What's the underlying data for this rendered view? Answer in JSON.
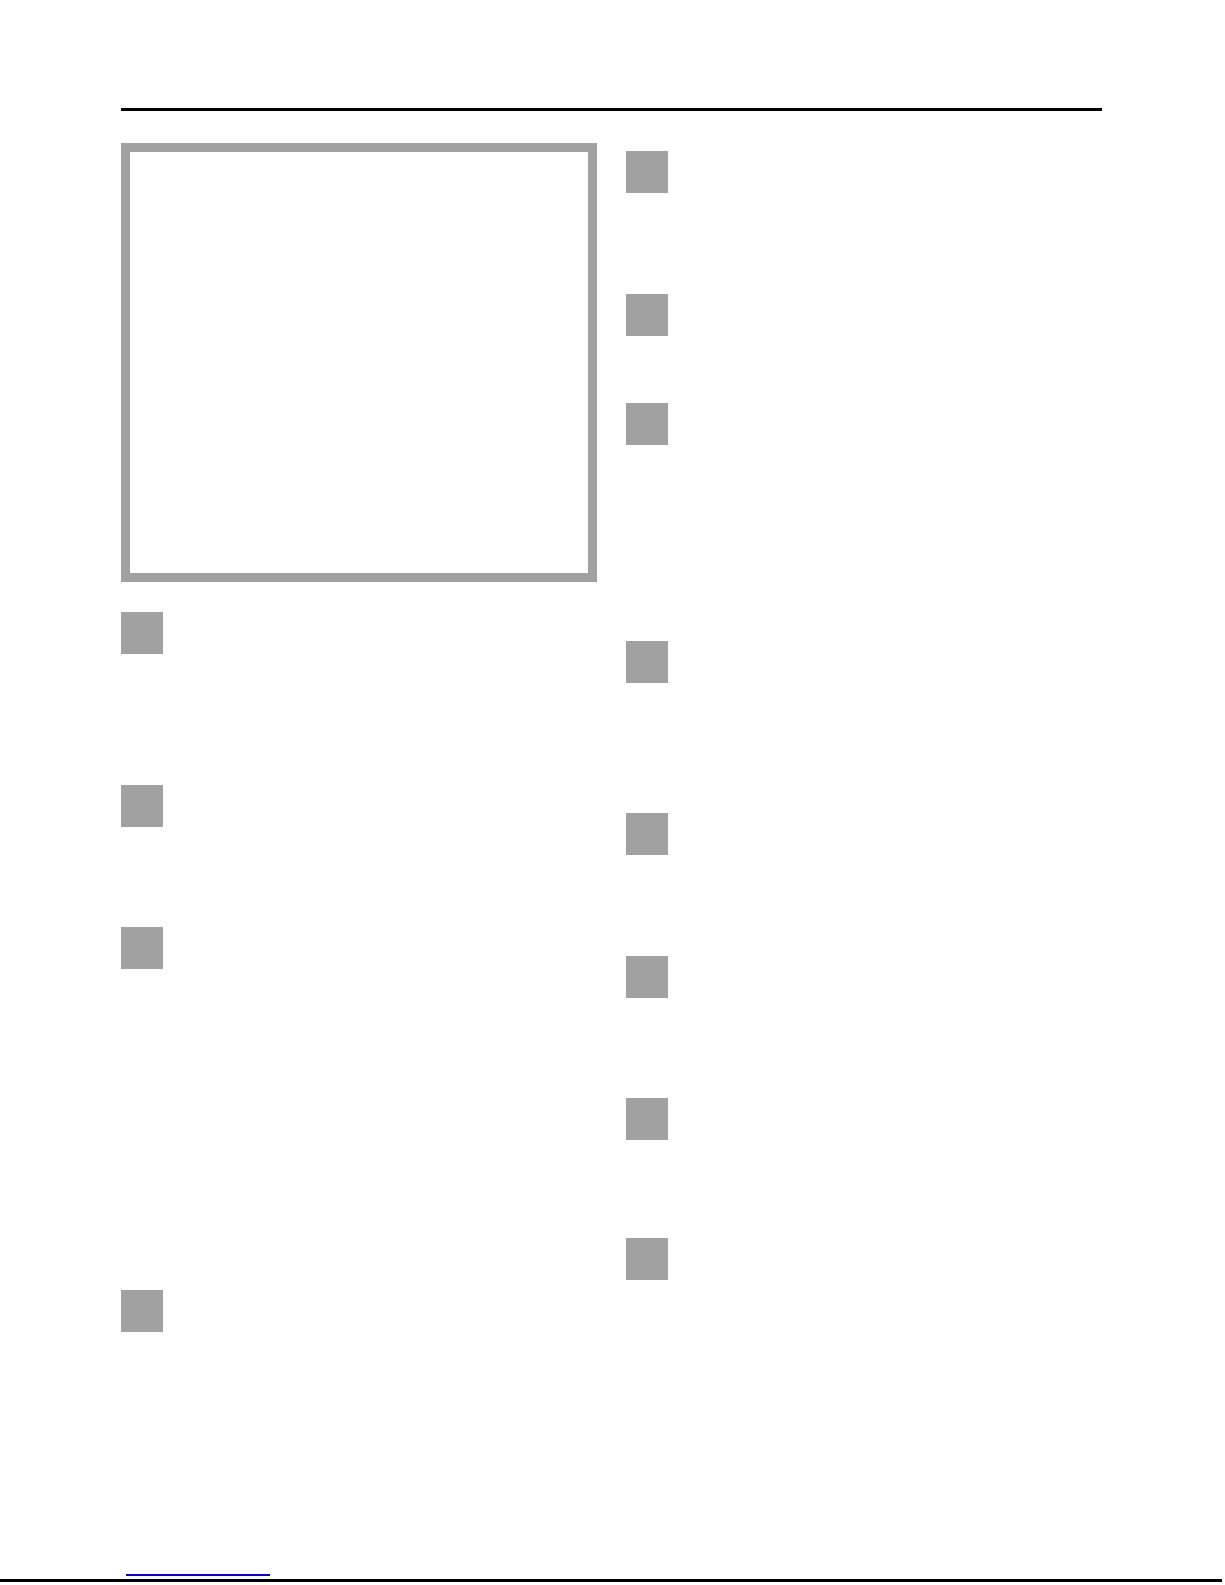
{
  "page": {
    "background_color": "#ffffff"
  },
  "header": {
    "rule_color": "#000000"
  },
  "illustration": {
    "border_color": "#a1a1a1",
    "fill_color": "#ffffff"
  },
  "step_markers": {
    "color": "#a1a1a1",
    "count": 12,
    "left_column": [
      {
        "x": 121,
        "y": 612
      },
      {
        "x": 121,
        "y": 785
      },
      {
        "x": 121,
        "y": 927
      },
      {
        "x": 121,
        "y": 1290
      }
    ],
    "right_column": [
      {
        "x": 626,
        "y": 151
      },
      {
        "x": 626,
        "y": 294
      },
      {
        "x": 626,
        "y": 403
      },
      {
        "x": 626,
        "y": 641
      },
      {
        "x": 626,
        "y": 813
      },
      {
        "x": 626,
        "y": 956
      },
      {
        "x": 626,
        "y": 1098
      },
      {
        "x": 626,
        "y": 1238
      }
    ]
  },
  "footer": {
    "link_underline_color": "#0000ee",
    "page_edge_color": "#000000"
  }
}
